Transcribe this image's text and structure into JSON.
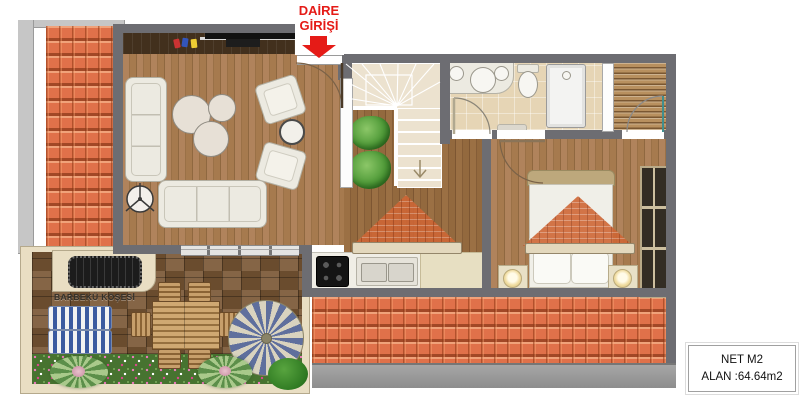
{
  "entrance": {
    "line1": "DAİRE",
    "line2": "GİRİŞİ"
  },
  "terrace": {
    "barbecue_label": "BARBEKÜ KÖŞESİ"
  },
  "area_info": {
    "line1": "NET M2",
    "line2": "ALAN :64.64m2"
  },
  "colors": {
    "wall": "#6d6d72",
    "roof_tile": "#e0714a",
    "entrance_red": "#e51b17",
    "wood_living": "#a87c50",
    "wood_hall": "#93693e",
    "wood_terrace": "#7b5836",
    "cream": "#e9dec3",
    "stairs_floor": "#ece2cf",
    "bath_tile": "#e6d5b5",
    "deck": "#b8905f",
    "glass": "#dcdcdc",
    "white_furniture": "#eceae1",
    "parasol_blue": "#5f6f9d",
    "parasol_cream": "#d9d3bf",
    "lounger_blue": "#3b5aa0",
    "plant_green": "#4f9a38",
    "flowerbed_green": "#477330"
  }
}
